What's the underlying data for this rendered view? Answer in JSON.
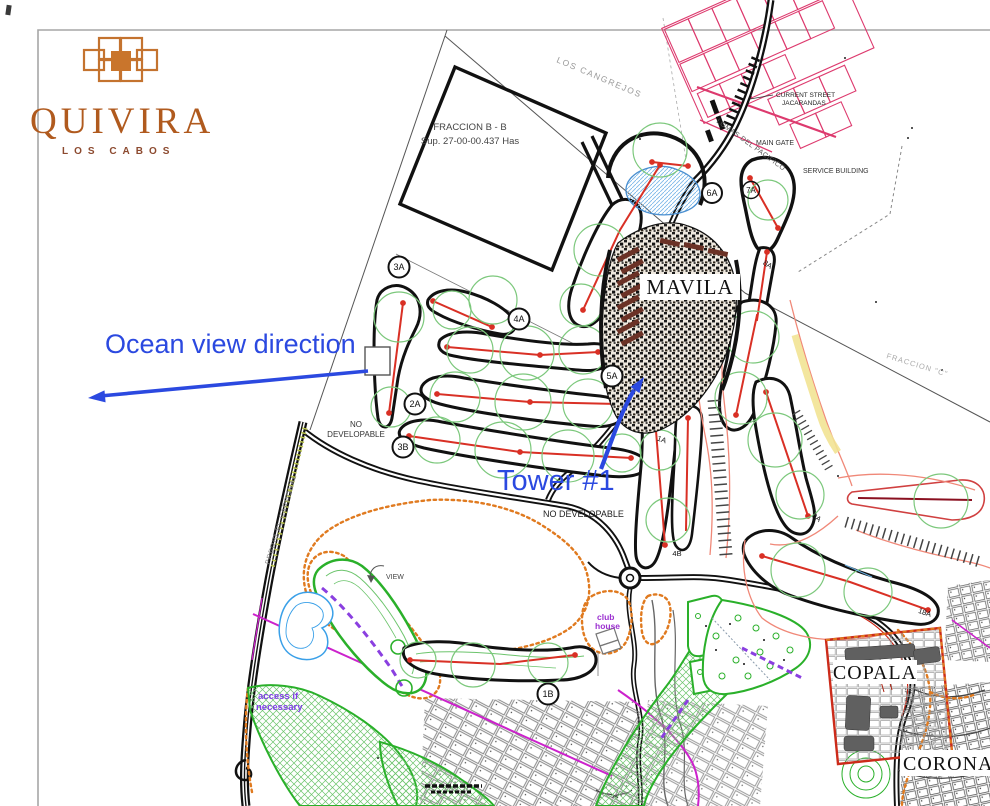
{
  "brand": {
    "name": "QUIVIRA",
    "location": "LOS CABOS"
  },
  "annotations": {
    "ocean_view": "Ocean view direction",
    "tower": "Tower #1",
    "color": "#2b49e0"
  },
  "parcels": {
    "fraccion_bb_line1": "FRACCION B - B",
    "fraccion_bb_line2": "Sup. 27-00-00.437 Has",
    "los_cangrejos": "LOS CANGREJOS",
    "fraccion_c": "FRACCION \"C\"",
    "predio_el_cardonal": "PREDIO EL CARDONAL"
  },
  "places": {
    "mavila": "MAVILA",
    "copala": "COPALA",
    "coronado": "CORONADO",
    "main_gate": "MAIN GATE",
    "service_building": "SERVICE BUILDING",
    "current_street_line1": "CURRENT STREET",
    "current_street_line2": "JACARANDAS",
    "lomas_pacifico": "LOMAS DEL PACIFICO",
    "club_house_line1": "club",
    "club_house_line2": "house",
    "no_developable_line1": "NO",
    "no_developable_line2": "DEVELOPABLE",
    "no_developable_center": "NO DEVELOPABLE",
    "access_line1": "access if",
    "access_line2": "necessary",
    "view": "VIEW"
  },
  "holes": {
    "h3a": "3A",
    "h4a": "4A",
    "h5a": "5A",
    "h2a": "2A",
    "h3b": "3B",
    "h1a": "1A",
    "h4b": "4B",
    "h6a": "6A",
    "h7a": "7A",
    "h8a": "8A",
    "h9a": "9A",
    "h18a": "18A",
    "h1b": "1B"
  },
  "colors": {
    "annotation_blue": "#2b49e0",
    "brand_copper": "#b05a1e",
    "golf_green": "#7cc87c",
    "hole_red": "#d93025",
    "boundary_orange": "#e07a1f",
    "lot_pink": "#dd3a6e",
    "path_magenta": "#cc22cc",
    "cart_purple": "#8a3fe0",
    "water_blue": "#4a8fd0"
  }
}
